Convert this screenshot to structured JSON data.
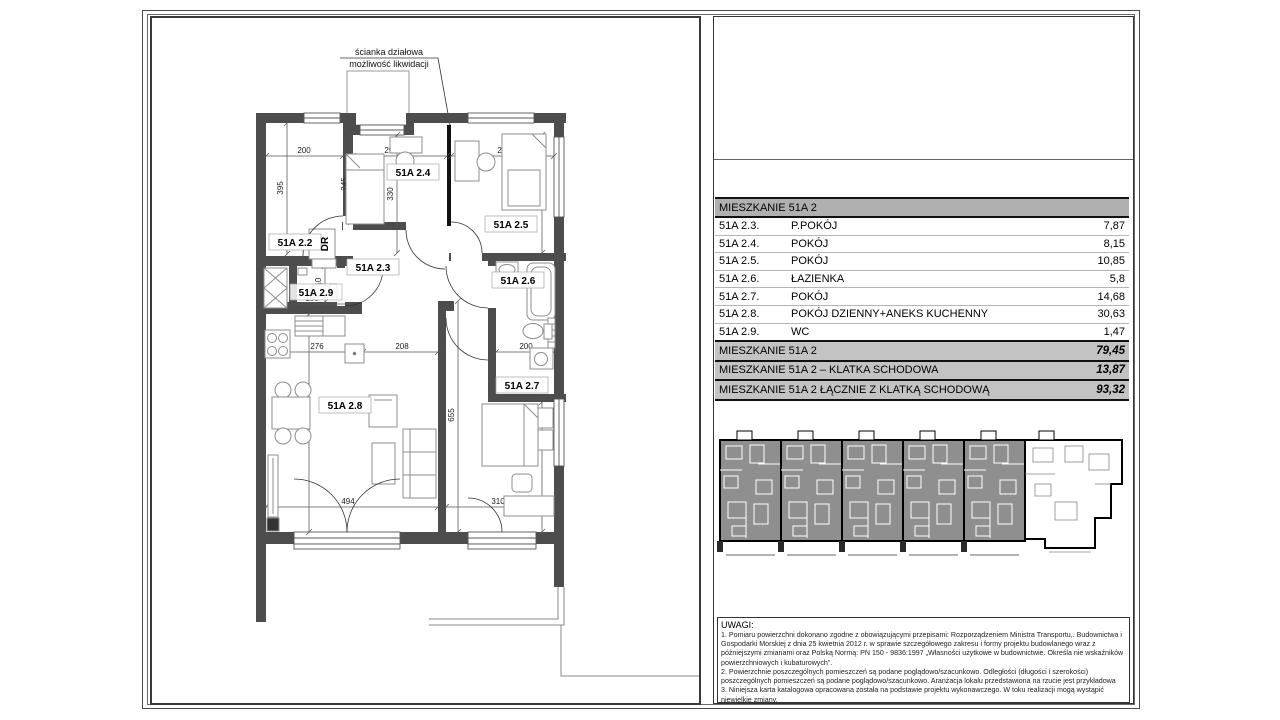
{
  "floor_plan": {
    "partition_note": {
      "line1": "ścianka działowa",
      "line2": "możliwość likwidacji"
    },
    "labels": {
      "r22": "51A 2.2",
      "r23": "51A 2.3",
      "r24": "51A 2.4",
      "r25": "51A 2.5",
      "r26": "51A 2.6",
      "r27": "51A 2.7",
      "r28": "51A 2.8",
      "r29": "51A 2.9",
      "dr": "DR"
    },
    "dims": {
      "d200a": "200",
      "d395": "395",
      "d295": "295",
      "d245": "245",
      "d330": "330",
      "d299": "299",
      "d370": "370",
      "d110": "110",
      "d150": "150",
      "d276": "276",
      "d208": "208",
      "d200b": "200",
      "d631": "631",
      "d655": "655",
      "d456": "456",
      "d494": "494",
      "d310": "310"
    },
    "wall_color": "#4d4d4d",
    "partition_color": "#111111"
  },
  "table": {
    "header": "MIESZKANIE 51A 2",
    "rows": [
      {
        "code": "51A 2.3.",
        "name": "P.POKÓJ",
        "area": "7,87"
      },
      {
        "code": "51A 2.4.",
        "name": "POKÓJ",
        "area": "8,15"
      },
      {
        "code": "51A 2.5.",
        "name": "POKÓJ",
        "area": "10,85"
      },
      {
        "code": "51A 2.6.",
        "name": "ŁAZIENKA",
        "area": "5,8"
      },
      {
        "code": "51A 2.7.",
        "name": "POKÓJ",
        "area": "14,68"
      },
      {
        "code": "51A 2.8.",
        "name": "POKÓJ DZIENNY+ANEKS KUCHENNY",
        "area": "30,63"
      },
      {
        "code": "51A 2.9.",
        "name": "WC",
        "area": "1,47"
      }
    ],
    "summary": [
      {
        "label": "MIESZKANIE 51A 2",
        "value": "79,45"
      },
      {
        "label": "MIESZKANIE 51A 2 – KLATKA SCHODOWA",
        "value": "13,87"
      },
      {
        "label": "MIESZKANIE 51A 2 ŁĄCZNIE Z KLATKĄ SCHODOWĄ",
        "value": "93,32"
      }
    ],
    "header_bg": "#b0b0b0",
    "summary_bg": "#c3c3c3"
  },
  "notes": {
    "title": "UWAGI:",
    "items": [
      "1. Pomiaru powierzchni dokonano zgodne z obowiązującymi przepisami: Rozporządzeniem Ministra Transportu,. Budownictwa i Gospodarki Morskiej z dnia 25 kwietnia 2012 r. w sprawie szczegółowego zakresu i formy projektu budowlanego wraz z późniejszymi zmianami oraz Polską Normą: PN 150 - 9836:1997 „Własności użytkowe w budownictwie. Określa nie wskaźników powierzchniowych i kubaturowych”.",
      "2. Powierzchnie poszczególnych pomieszczeń są podane poglądowo/szacunkowo. Odległości (długości i szerokości) poszczególnych pomieszczeń są podane poglądowo/szacunkowo. Aranżacja lokalu przedstawiona na rzucie jest przykładowa",
      "3. Niniejsza karta katalogowa opracowana została na podstawie projektu wykonawczego. W toku realizacji mogą wystąpić niewielkie zmiany."
    ]
  }
}
